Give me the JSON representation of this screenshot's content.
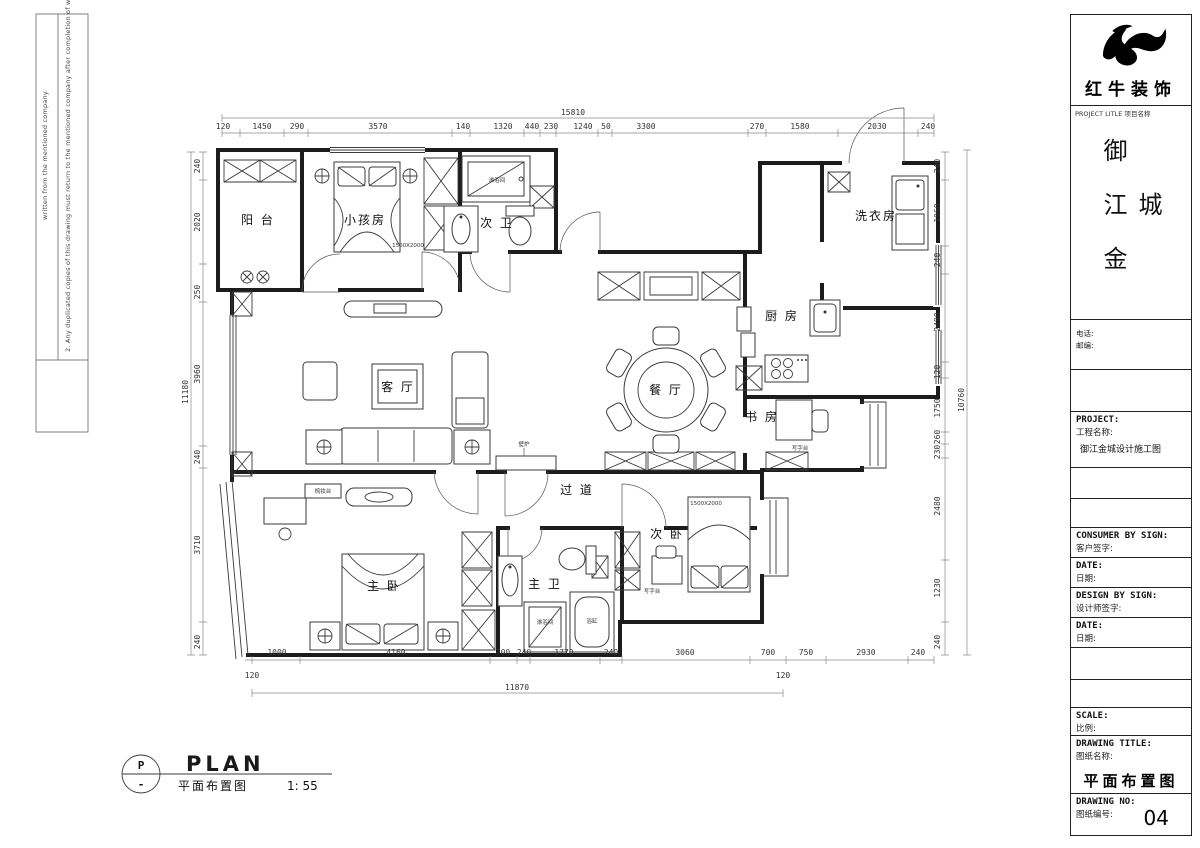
{
  "margin_notes": {
    "line1": "written from the mentioned company.",
    "line2": "2. Any duplicated copies of this drawing must return to  the mentioned company after completion of work."
  },
  "title_block": {
    "company": "红牛装饰",
    "subtitle": "PROJECT LITLE  项目名称",
    "project_name_vertical": "御江金城",
    "phone_label": "电话:",
    "postcode_label": "邮编:",
    "project_label_en": "PROJECT:",
    "project_label_cn": "工程名称:",
    "project_value": "御江金城设计施工图",
    "consumer_sign_en": "CONSUMER BY SIGN:",
    "consumer_sign_cn": "客户签字:",
    "date1_en": "DATE:",
    "date1_cn": "日期:",
    "design_sign_en": "DESIGN BY SIGN:",
    "design_sign_cn": "设计师签字:",
    "date2_en": "DATE:",
    "date2_cn": "日期:",
    "scale_en": "SCALE:",
    "scale_cn": "比例:",
    "drawing_title_en": "DRAWING TITLE:",
    "drawing_title_cn": "图纸名称:",
    "drawing_title_value": "平面布置图",
    "drawing_no_en": "DRAWING NO:",
    "drawing_no_cn": "图纸编号:",
    "drawing_no_value": "04"
  },
  "footer": {
    "bubble_top": "P",
    "bubble_bottom": "-",
    "title_en": "PLAN",
    "title_cn": "平面布置图",
    "scale": "1: 55"
  },
  "rooms": {
    "balcony": "阳 台",
    "kids_room": "小孩房",
    "guest_bath": "次 卫",
    "laundry": "洗衣房",
    "kitchen": "厨 房",
    "dining": "餐 厅",
    "living": "客 厅",
    "study": "书 房",
    "corridor": "过 道",
    "master_bedroom": "主 卧",
    "master_bath": "主 卫",
    "second_bedroom": "次 卧"
  },
  "fixtures": {
    "guest_shower": "淋浴间",
    "master_shower": "淋浴间",
    "bathtub": "浴缸",
    "study_desk": "写字台",
    "bedroom2_desk": "写字台",
    "dresser": "梳妆台",
    "fireplace": "壁炉",
    "kids_bed_size": "1500X2000",
    "bed2_size": "1500X2000"
  },
  "dims": {
    "top_total": "15810",
    "top": [
      "120",
      "1450",
      "290",
      "3570",
      "140",
      "1320",
      "440",
      "230",
      "1240",
      "50",
      "3300",
      "270",
      "1580",
      "2030",
      "240"
    ],
    "left_total": "11180",
    "left": [
      "240",
      "2020",
      "250",
      "3960",
      "240",
      "3710",
      "240"
    ],
    "right_total": "10760",
    "right": [
      "240",
      "1960",
      "240",
      "2490",
      "120",
      "1750",
      "260",
      "230",
      "2480",
      "1230",
      "240"
    ],
    "bottom": [
      "1000",
      "4160",
      "700",
      "240",
      "1770",
      "240",
      "3060",
      "700",
      "750",
      "2930",
      "240"
    ],
    "bottom_sub": [
      "120",
      "120"
    ],
    "bottom_total": "11870"
  }
}
